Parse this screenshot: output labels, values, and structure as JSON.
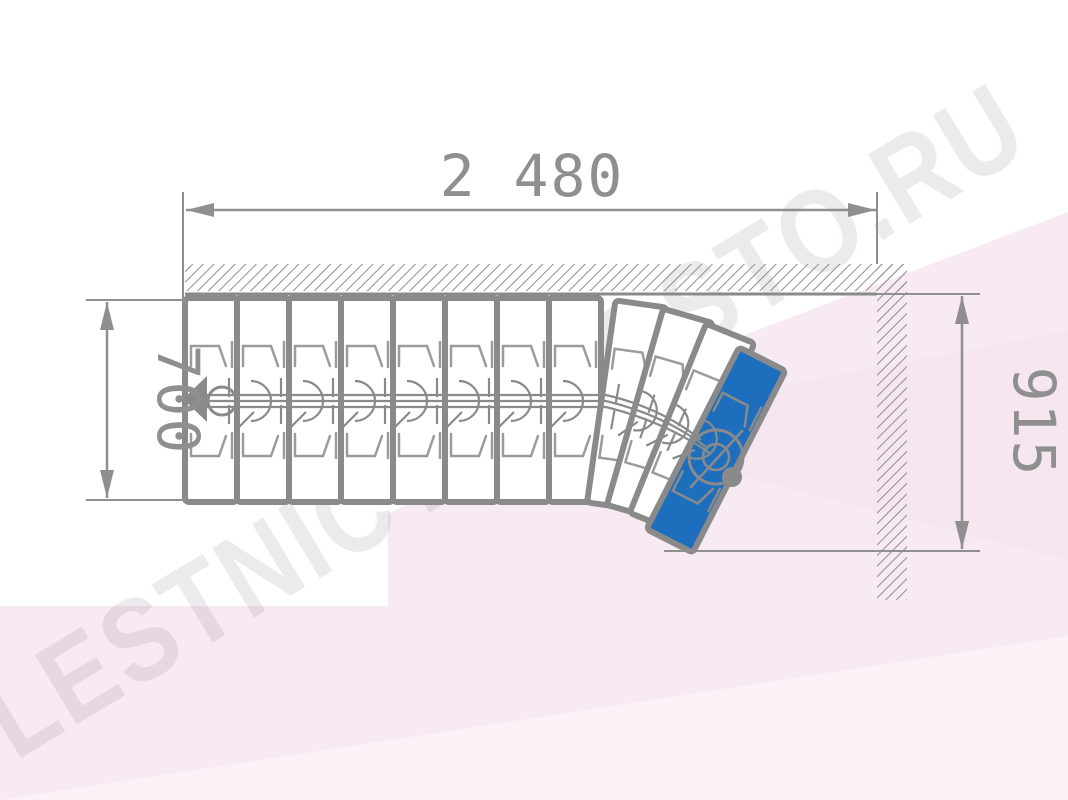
{
  "watermark": {
    "text": "LESTNICY-PROSTO.RU"
  },
  "dimensions": {
    "top": {
      "value": "2 480",
      "orientation": "horizontal"
    },
    "left": {
      "value": "700",
      "orientation": "vertical"
    },
    "right": {
      "value": "915",
      "orientation": "vertical"
    }
  },
  "drawing": {
    "type": "modular-staircase-plan",
    "straight_steps": 8,
    "straight": {
      "x0": 185,
      "step_w": 52,
      "top": 300,
      "height": 200
    },
    "fan_steps": [
      {
        "x": 627,
        "y": 405,
        "deg": 8,
        "highlight": false
      },
      {
        "x": 660,
        "y": 414,
        "deg": 16,
        "highlight": false
      },
      {
        "x": 692,
        "y": 428,
        "deg": 22,
        "highlight": false
      },
      {
        "x": 716,
        "y": 450,
        "deg": 27,
        "highlight": true
      }
    ],
    "colors": {
      "line": "#8a8a8a",
      "detail_line": "#9b9b9b",
      "step_fill": "#ffffff",
      "highlight_step": "#1d6fbe",
      "dim_text": "#8f8f8f",
      "bg_pink_main": "#f7eaf3",
      "bg_pink_deep": "#f5e6f0",
      "bg_pink_light": "#fbf2f8",
      "watermark": "rgba(128,112,126,0.15)"
    }
  }
}
